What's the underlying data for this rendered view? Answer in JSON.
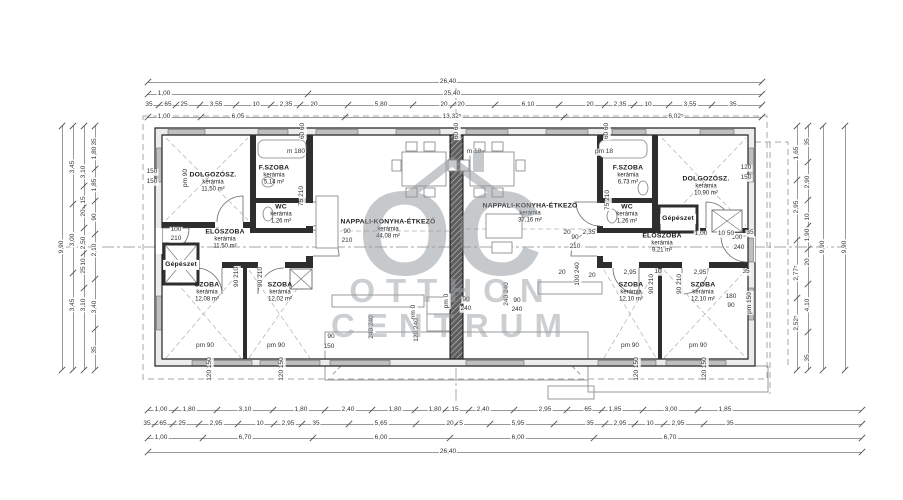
{
  "watermark": {
    "monogram": "OC",
    "brand_line1": "OTTHON",
    "brand_line2": "CENTRUM",
    "color": "#8f959b"
  },
  "plan": {
    "rooms": [
      {
        "name": "DOLGOZÓSZ.",
        "material": "kerámia",
        "area": "11,50 m²",
        "x": 213,
        "y": 183
      },
      {
        "name": "F.SZOBA",
        "material": "kerámia",
        "area": "5,14 m²",
        "x": 274,
        "y": 176
      },
      {
        "name": "WC",
        "material": "kerámia",
        "area": "1,26 m²",
        "x": 281,
        "y": 215
      },
      {
        "name": "ELŐSZOBA",
        "material": "kerámia",
        "area": "11,50 m²",
        "x": 225,
        "y": 240
      },
      {
        "name": "Gépészet",
        "material": "",
        "area": "",
        "x": 181,
        "y": 265,
        "boxed": true
      },
      {
        "name": "SZOBA",
        "material": "kerámia",
        "area": "12,08 m²",
        "x": 207,
        "y": 293
      },
      {
        "name": "SZOBA",
        "material": "kerámia",
        "area": "12,02 m²",
        "x": 280,
        "y": 293
      },
      {
        "name": "NAPPALI-KONYHA-ÉTKEZŐ",
        "material": "kerámia",
        "area": "44,08 m²",
        "x": 388,
        "y": 230
      },
      {
        "name": "NAPPALI-KONYHA-ÉTKEZŐ",
        "material": "kerámia",
        "area": "37,16 m²",
        "x": 530,
        "y": 214
      },
      {
        "name": "F.SZOBA",
        "material": "kerámia",
        "area": "6,73 m²",
        "x": 628,
        "y": 176
      },
      {
        "name": "DOLGOZÓSZ.",
        "material": "kerámia",
        "area": "10,90 m²",
        "x": 706,
        "y": 187
      },
      {
        "name": "WC",
        "material": "kerámia",
        "area": "1,26 m²",
        "x": 627,
        "y": 215
      },
      {
        "name": "Gépészet",
        "material": "",
        "area": "",
        "x": 678,
        "y": 219,
        "boxed": true
      },
      {
        "name": "ELŐSZOBA",
        "material": "kerámia",
        "area": "9,21 m²",
        "x": 662,
        "y": 244
      },
      {
        "name": "SZOBA",
        "material": "kerámia",
        "area": "12,10 m²",
        "x": 631,
        "y": 293
      },
      {
        "name": "SZOBA",
        "material": "kerámia",
        "area": "12,10 m²",
        "x": 703,
        "y": 293
      }
    ],
    "annotations": [
      {
        "t": "150",
        "x": 152,
        "y": 172
      },
      {
        "t": "150",
        "x": 152,
        "y": 182
      },
      {
        "t": "pm 90",
        "x": 186,
        "y": 178,
        "r": 1
      },
      {
        "t": "100",
        "x": 176,
        "y": 230
      },
      {
        "t": "210",
        "x": 176,
        "y": 239
      },
      {
        "t": "m 180",
        "x": 296,
        "y": 152
      },
      {
        "t": "m 18",
        "x": 474,
        "y": 152
      },
      {
        "t": "pm 18",
        "x": 604,
        "y": 152
      },
      {
        "t": "60 60",
        "x": 303,
        "y": 131,
        "r": 1
      },
      {
        "t": "60 60",
        "x": 457,
        "y": 131,
        "r": 1
      },
      {
        "t": "60 60",
        "x": 607,
        "y": 131,
        "r": 1
      },
      {
        "t": "75 210",
        "x": 302,
        "y": 196,
        "r": 1
      },
      {
        "t": "75 210",
        "x": 608,
        "y": 200,
        "r": 1
      },
      {
        "t": "90",
        "x": 347,
        "y": 232
      },
      {
        "t": "210",
        "x": 347,
        "y": 241
      },
      {
        "t": "90",
        "x": 575,
        "y": 238
      },
      {
        "t": "210",
        "x": 575,
        "y": 247
      },
      {
        "t": "90 210",
        "x": 237,
        "y": 277,
        "r": 1
      },
      {
        "t": "90 210",
        "x": 261,
        "y": 277,
        "r": 1
      },
      {
        "t": "90 210",
        "x": 652,
        "y": 284,
        "r": 1
      },
      {
        "t": "90 210",
        "x": 680,
        "y": 284,
        "r": 1
      },
      {
        "t": "pm 90",
        "x": 205,
        "y": 346
      },
      {
        "t": "pm 90",
        "x": 276,
        "y": 346
      },
      {
        "t": "pm 90",
        "x": 630,
        "y": 346
      },
      {
        "t": "pm 90",
        "x": 698,
        "y": 346
      },
      {
        "t": "120 150",
        "x": 210,
        "y": 369,
        "r": 1
      },
      {
        "t": "120 150",
        "x": 282,
        "y": 369,
        "r": 1
      },
      {
        "t": "120 150",
        "x": 637,
        "y": 369,
        "r": 1
      },
      {
        "t": "120 150",
        "x": 705,
        "y": 369,
        "r": 1
      },
      {
        "t": "120",
        "x": 746,
        "y": 168
      },
      {
        "t": "150",
        "x": 746,
        "y": 178
      },
      {
        "t": "100",
        "x": 737,
        "y": 238
      },
      {
        "t": "240",
        "x": 739,
        "y": 248
      },
      {
        "t": "180",
        "x": 731,
        "y": 297
      },
      {
        "t": "90",
        "x": 731,
        "y": 306
      },
      {
        "t": "pm 150",
        "x": 750,
        "y": 303,
        "r": 1
      },
      {
        "t": "100 240",
        "x": 578,
        "y": 274,
        "r": 1
      },
      {
        "t": "20",
        "x": 592,
        "y": 276
      },
      {
        "t": "20",
        "x": 567,
        "y": 233
      },
      {
        "t": "2,35",
        "x": 589,
        "y": 233
      },
      {
        "t": "1,00",
        "x": 701,
        "y": 234
      },
      {
        "t": "10 50",
        "x": 726,
        "y": 234
      },
      {
        "t": "35",
        "x": 750,
        "y": 233
      },
      {
        "t": "20",
        "x": 562,
        "y": 273
      },
      {
        "t": "2,95",
        "x": 630,
        "y": 273
      },
      {
        "t": "10",
        "x": 658,
        "y": 272
      },
      {
        "t": "2,95",
        "x": 700,
        "y": 273
      },
      {
        "t": "35",
        "x": 746,
        "y": 272
      },
      {
        "t": "pm 0",
        "x": 447,
        "y": 301,
        "r": 1
      },
      {
        "t": "pm 0",
        "x": 414,
        "y": 312,
        "r": 1
      },
      {
        "t": "90",
        "x": 466,
        "y": 300
      },
      {
        "t": "240",
        "x": 466,
        "y": 309
      },
      {
        "t": "90",
        "x": 517,
        "y": 301
      },
      {
        "t": "240",
        "x": 517,
        "y": 310
      },
      {
        "t": "240 240",
        "x": 372,
        "y": 327,
        "r": 1
      },
      {
        "t": "120 240",
        "x": 417,
        "y": 330,
        "r": 1
      },
      {
        "t": "240 240",
        "x": 507,
        "y": 294,
        "r": 1
      },
      {
        "t": "90",
        "x": 331,
        "y": 337
      },
      {
        "t": "150",
        "x": 329,
        "y": 347
      }
    ]
  },
  "dimensions": {
    "rows": [
      {
        "o": "h",
        "pos": 82,
        "a": 148,
        "b": 762,
        "items": [
          {
            "t": "26,40",
            "c": 448
          }
        ]
      },
      {
        "o": "h",
        "pos": 94,
        "a": 148,
        "b": 762,
        "items": [
          {
            "t": "1,00",
            "c": 164
          },
          {
            "t": "25,40",
            "c": 452
          }
        ]
      },
      {
        "o": "h",
        "pos": 105,
        "a": 148,
        "b": 762,
        "items": [
          {
            "t": "35",
            "c": 149
          },
          {
            "t": "65",
            "c": 168
          },
          {
            "t": "25",
            "c": 184
          },
          {
            "t": "3,55",
            "c": 216
          },
          {
            "t": "10",
            "c": 256
          },
          {
            "t": "2,35",
            "c": 286
          },
          {
            "t": "20",
            "c": 314
          },
          {
            "t": "5,80",
            "c": 381
          },
          {
            "t": "20",
            "c": 444
          },
          {
            "t": "20",
            "c": 461
          },
          {
            "t": "6,10",
            "c": 528
          },
          {
            "t": "20",
            "c": 590
          },
          {
            "t": "2,35",
            "c": 620
          },
          {
            "t": "10",
            "c": 648
          },
          {
            "t": "3,55",
            "c": 690
          },
          {
            "t": "35",
            "c": 733
          }
        ]
      },
      {
        "o": "h",
        "pos": 117,
        "a": 148,
        "b": 762,
        "items": [
          {
            "t": "1,00",
            "c": 164
          },
          {
            "t": "6,05",
            "c": 238
          },
          {
            "t": "13,32⁵",
            "c": 452
          },
          {
            "t": "6,02⁵",
            "c": 676
          }
        ]
      },
      {
        "o": "h",
        "pos": 410,
        "a": 148,
        "b": 862,
        "items": [
          {
            "t": "1,00",
            "c": 161
          },
          {
            "t": "1,80",
            "c": 189
          },
          {
            "t": "3,10",
            "c": 245
          },
          {
            "t": "1,80",
            "c": 301
          },
          {
            "t": "2,40",
            "c": 348
          },
          {
            "t": "1,80",
            "c": 395
          },
          {
            "t": "1,80",
            "c": 435
          },
          {
            "t": "15",
            "c": 455
          },
          {
            "t": "2,40",
            "c": 483
          },
          {
            "t": "2,95",
            "c": 545
          },
          {
            "t": "65",
            "c": 588
          },
          {
            "t": "1,85",
            "c": 615
          },
          {
            "t": "3,00",
            "c": 671
          },
          {
            "t": "1,85",
            "c": 725
          }
        ]
      },
      {
        "o": "h",
        "pos": 424,
        "a": 148,
        "b": 862,
        "items": [
          {
            "t": "35",
            "c": 147
          },
          {
            "t": "65",
            "c": 163
          },
          {
            "t": "25",
            "c": 182
          },
          {
            "t": "2,95",
            "c": 216
          },
          {
            "t": "10",
            "c": 260
          },
          {
            "t": "2,95",
            "c": 288
          },
          {
            "t": "35",
            "c": 316
          },
          {
            "t": "5,65",
            "c": 381
          },
          {
            "t": "20",
            "c": 450
          },
          {
            "t": "5",
            "c": 461
          },
          {
            "t": "5,95",
            "c": 518
          },
          {
            "t": "35",
            "c": 590
          },
          {
            "t": "2,95",
            "c": 620
          },
          {
            "t": "10",
            "c": 650
          },
          {
            "t": "2,95",
            "c": 678
          },
          {
            "t": "35",
            "c": 730
          }
        ]
      },
      {
        "o": "h",
        "pos": 438,
        "a": 148,
        "b": 862,
        "items": [
          {
            "t": "1,00",
            "c": 161
          },
          {
            "t": "6,70",
            "c": 245
          },
          {
            "t": "6,00",
            "c": 381
          },
          {
            "t": "6,00",
            "c": 518
          },
          {
            "t": "6,70",
            "c": 670
          }
        ]
      },
      {
        "o": "h",
        "pos": 452,
        "a": 148,
        "b": 862,
        "items": [
          {
            "t": "26,40",
            "c": 448
          }
        ]
      },
      {
        "o": "v",
        "pos": 62,
        "a": 126,
        "b": 370,
        "items": [
          {
            "t": "9,90",
            "c": 247
          }
        ]
      },
      {
        "o": "v",
        "pos": 73,
        "a": 126,
        "b": 370,
        "items": [
          {
            "t": "3,45",
            "c": 167
          },
          {
            "t": "3,00",
            "c": 240
          },
          {
            "t": "3,45",
            "c": 305
          }
        ]
      },
      {
        "o": "v",
        "pos": 84,
        "a": 126,
        "b": 370,
        "items": [
          {
            "t": "3,10",
            "c": 172
          },
          {
            "t": "15",
            "c": 200
          },
          {
            "t": "20",
            "c": 213
          },
          {
            "t": "2,50",
            "c": 243
          },
          {
            "t": "10",
            "c": 262
          },
          {
            "t": "25",
            "c": 270
          },
          {
            "t": "3,10",
            "c": 305
          }
        ]
      },
      {
        "o": "v",
        "pos": 95,
        "a": 126,
        "b": 370,
        "items": [
          {
            "t": "35",
            "c": 142
          },
          {
            "t": "1,80",
            "c": 153
          },
          {
            "t": "1,85",
            "c": 185
          },
          {
            "t": "90",
            "c": 217
          },
          {
            "t": "2,10",
            "c": 250
          },
          {
            "t": "3,40",
            "c": 307
          },
          {
            "t": "35",
            "c": 350
          }
        ]
      },
      {
        "o": "v",
        "pos": 797,
        "a": 126,
        "b": 370,
        "items": [
          {
            "t": "1,65",
            "c": 153
          },
          {
            "t": "2,95",
            "c": 207
          },
          {
            "t": "2,77⁵",
            "c": 273
          },
          {
            "t": "2,52⁵",
            "c": 323
          }
        ]
      },
      {
        "o": "v",
        "pos": 808,
        "a": 126,
        "b": 370,
        "items": [
          {
            "t": "35",
            "c": 142
          },
          {
            "t": "2,90",
            "c": 182
          },
          {
            "t": "10",
            "c": 217
          },
          {
            "t": "1,90",
            "c": 235
          },
          {
            "t": "20",
            "c": 262
          },
          {
            "t": "4,10",
            "c": 305
          },
          {
            "t": "35",
            "c": 358
          }
        ]
      },
      {
        "o": "v",
        "pos": 823,
        "a": 126,
        "b": 370,
        "items": [
          {
            "t": "9,90",
            "c": 247
          }
        ]
      },
      {
        "o": "v",
        "pos": 845,
        "a": 126,
        "b": 370,
        "items": [
          {
            "t": "9,90",
            "c": 247
          }
        ]
      }
    ]
  }
}
